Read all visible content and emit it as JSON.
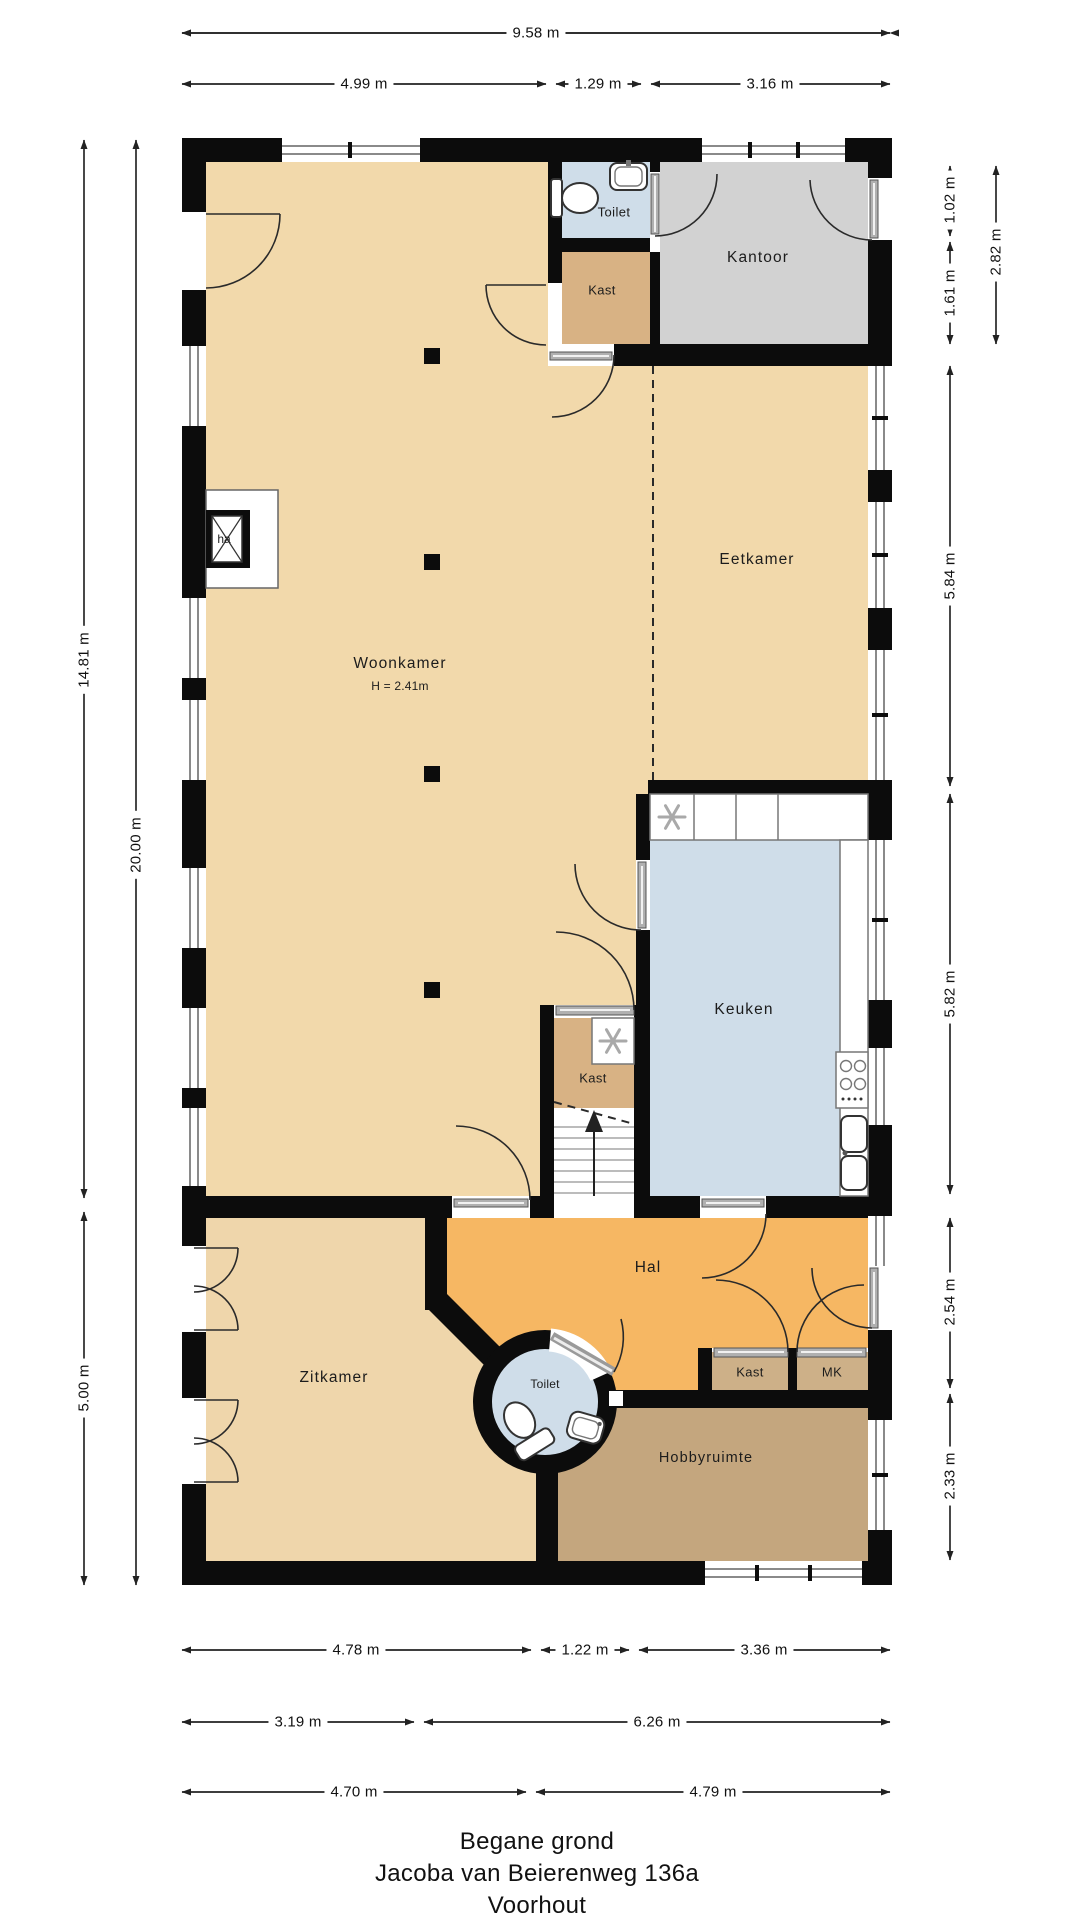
{
  "title": {
    "floor": "Begane grond",
    "address": "Jacoba van Beierenweg 136a",
    "city": "Voorhout"
  },
  "rooms": {
    "woonkamer": {
      "label": "Woonkamer",
      "height_note": "H = 2.41m"
    },
    "eetkamer": {
      "label": "Eetkamer"
    },
    "kantoor": {
      "label": "Kantoor"
    },
    "keuken": {
      "label": "Keuken"
    },
    "hal": {
      "label": "Hal"
    },
    "zitkamer": {
      "label": "Zitkamer"
    },
    "hobbyruimte": {
      "label": "Hobbyruimte"
    },
    "toilet_top": {
      "label": "Toilet"
    },
    "toilet_round": {
      "label": "Toilet"
    },
    "kast_top": {
      "label": "Kast"
    },
    "kast_mid": {
      "label": "Kast"
    },
    "kast_hal": {
      "label": "Kast"
    },
    "mk": {
      "label": "MK"
    },
    "fireplace": {
      "label": "ha"
    }
  },
  "dims": {
    "top_total": "9.58 m",
    "top_a": "4.99 m",
    "top_b": "1.29 m",
    "top_c": "3.16 m",
    "left_a": "14.81 m",
    "left_b": "5.00 m",
    "left_total": "20.00 m",
    "right_a": "1.02 m",
    "right_b": "1.61 m",
    "right_total_top": "2.82 m",
    "right_c": "5.84 m",
    "right_d": "5.82 m",
    "right_e": "2.54 m",
    "right_f": "2.33 m",
    "bottom_r1_a": "4.78 m",
    "bottom_r1_b": "1.22 m",
    "bottom_r1_c": "3.36 m",
    "bottom_r2_a": "3.19 m",
    "bottom_r2_b": "6.26 m",
    "bottom_r3_a": "4.70 m",
    "bottom_r3_b": "4.79 m"
  },
  "colors": {
    "room_tan": "#f2d9ab",
    "room_dark_tan": "#d8b284",
    "room_orange": "#f6b763",
    "room_brown": "#c4a67e",
    "room_blue": "#cfdde9",
    "room_gray": "#d2d2d2",
    "wall": "#0c0c0c"
  }
}
